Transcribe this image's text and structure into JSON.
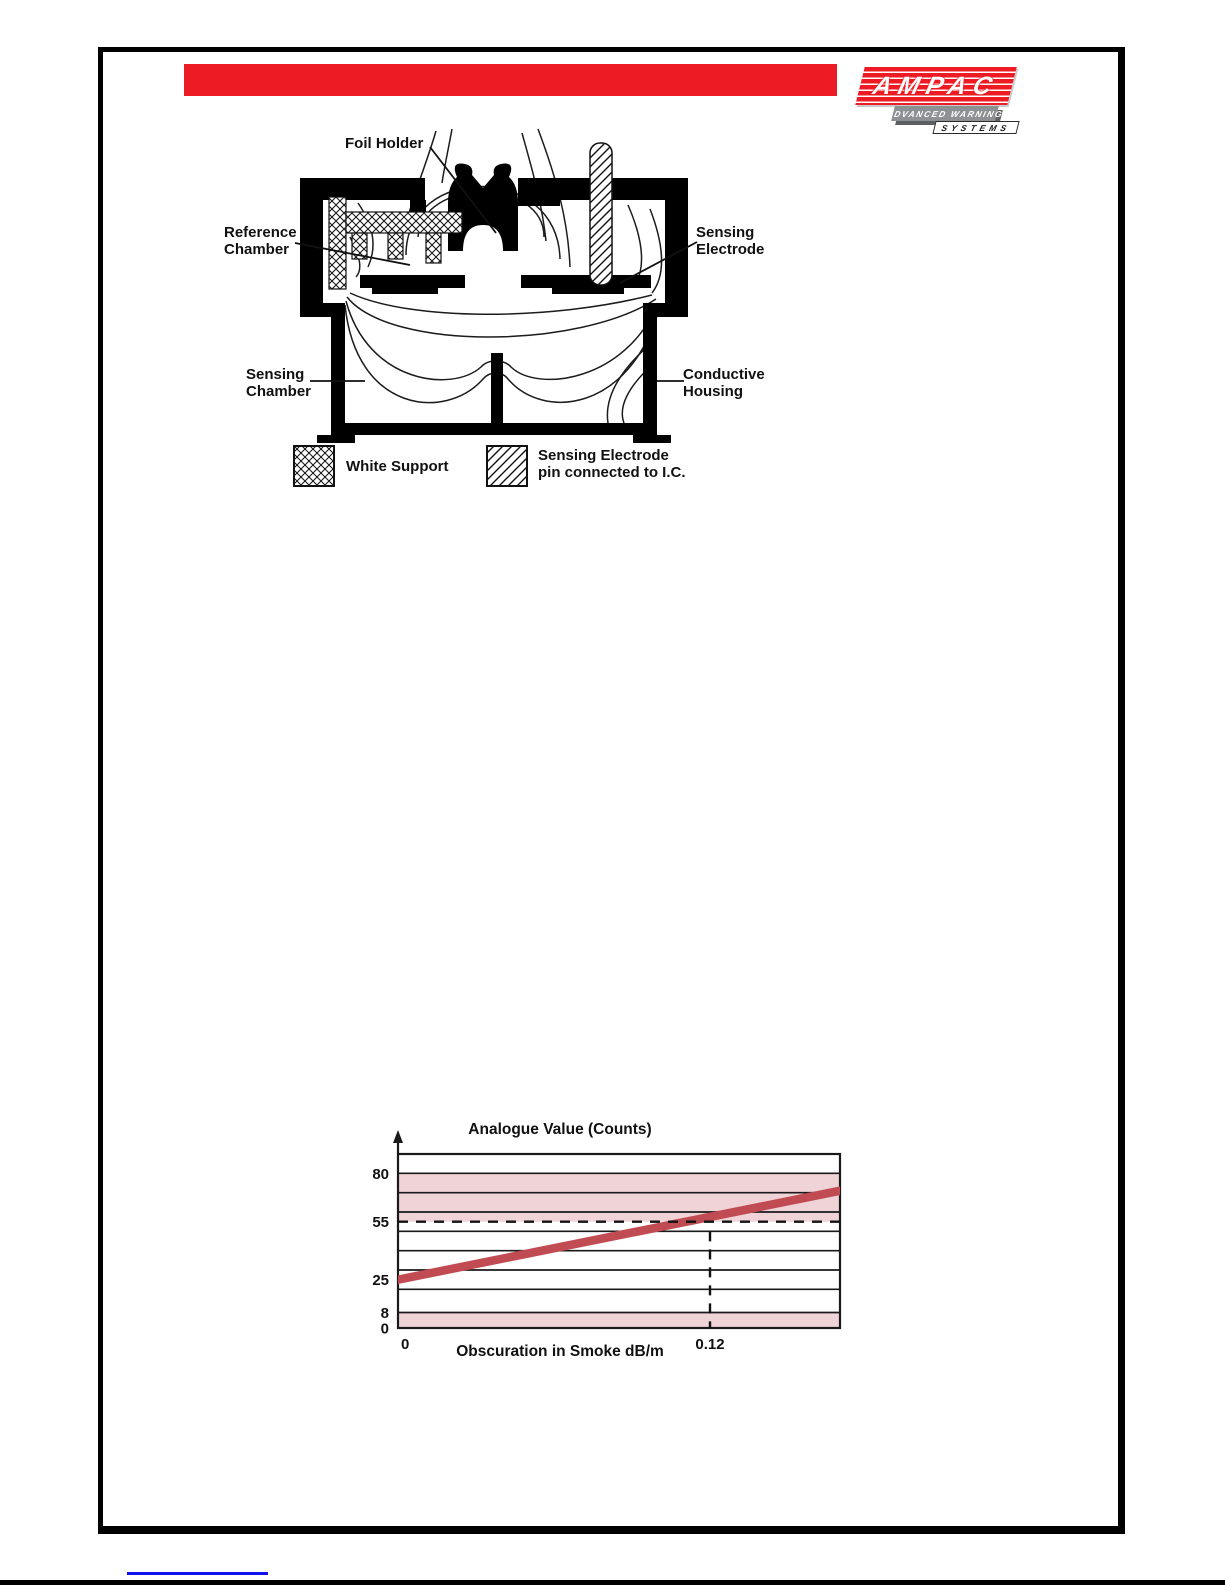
{
  "header": {
    "logo": {
      "brand": "AMPAC",
      "tagline": "ADVANCED WARNING",
      "subline": "SYSTEMS"
    },
    "bar_color": "#ED1C24"
  },
  "diagram": {
    "labels": {
      "foil_holder": "Foil Holder",
      "reference_chamber": {
        "line1": "Reference",
        "line2": "Chamber"
      },
      "sensing_electrode": {
        "line1": "Sensing",
        "line2": "Electrode"
      },
      "sensing_chamber": {
        "line1": "Sensing",
        "line2": "Chamber"
      },
      "conductive_housing": {
        "line1": "Conductive",
        "line2": "Housing"
      }
    },
    "legend": {
      "white_support_label": "White Support",
      "pin_label_line1": "Sensing Electrode",
      "pin_label_line2": "pin connected to I.C."
    }
  },
  "chart_data": {
    "type": "line",
    "title": "Analogue Value (Counts)",
    "xlabel": "Obscuration in Smoke dB/m",
    "ylabel": "",
    "xlim": [
      0,
      0.17
    ],
    "ylim": [
      0,
      90
    ],
    "y_tick_labels": [
      80,
      55,
      25,
      8,
      0
    ],
    "x_tick_labels": [
      "0",
      "0.12"
    ],
    "y_gridlines": [
      8,
      20,
      30,
      40,
      50,
      60,
      70,
      80
    ],
    "grid": "horizontal",
    "legend_position": "none",
    "bands": [
      {
        "from": 55,
        "to": 80,
        "color": "#EFD3D6"
      },
      {
        "from": 0,
        "to": 8,
        "color": "#EFD3D6"
      }
    ],
    "series": [
      {
        "name": "Analogue value vs smoke obscuration",
        "x": [
          0,
          0.17
        ],
        "y": [
          25,
          71
        ],
        "color": "#C14B52",
        "thickness_counts": 4.5
      }
    ],
    "alarm_threshold": {
      "y": 55,
      "x": 0.12,
      "vertical_dash_top": 50
    },
    "line_color": "#1a1a1a"
  },
  "footer": {
    "link_text": ""
  }
}
